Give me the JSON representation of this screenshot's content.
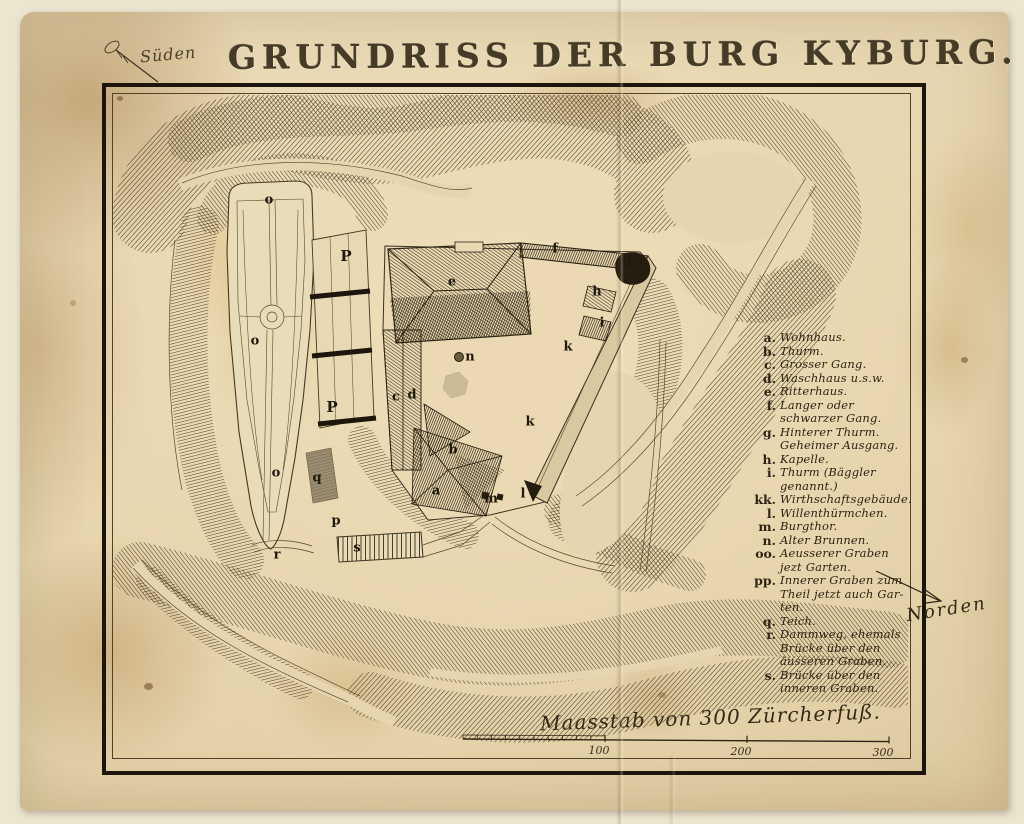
{
  "page": {
    "title": "GRUNDRISS DER BURG KYBURG.",
    "orientation_top": "Süden",
    "orientation_right": "Norden"
  },
  "legend": {
    "entries": [
      {
        "key": "a.",
        "lines": [
          "Wohnhaus."
        ]
      },
      {
        "key": "b.",
        "lines": [
          "Thurm."
        ]
      },
      {
        "key": "c.",
        "lines": [
          "Grosser Gang."
        ]
      },
      {
        "key": "d.",
        "lines": [
          "Waschhaus u.s.w."
        ]
      },
      {
        "key": "e.",
        "lines": [
          "Ritterhaus."
        ]
      },
      {
        "key": "f.",
        "lines": [
          "Langer oder",
          "schwarzer Gang."
        ]
      },
      {
        "key": "g.",
        "lines": [
          "Hinterer Thurm.",
          "Geheimer Ausgang."
        ]
      },
      {
        "key": "h.",
        "lines": [
          "Kapelle."
        ]
      },
      {
        "key": "i.",
        "lines": [
          "Thurm (Bäggler",
          "genannt.)"
        ]
      },
      {
        "key": "kk.",
        "lines": [
          "Wirthschaftsgebäude."
        ]
      },
      {
        "key": "l.",
        "lines": [
          "Willenthürmchen."
        ]
      },
      {
        "key": "m.",
        "lines": [
          "Burgthor."
        ]
      },
      {
        "key": "n.",
        "lines": [
          "Alter Brunnen."
        ]
      },
      {
        "key": "oo.",
        "lines": [
          "Aeusserer Graben",
          "jezt Garten."
        ]
      },
      {
        "key": "pp.",
        "lines": [
          "Innerer Graben zum",
          "Theil jetzt auch Gar-",
          "ten."
        ]
      },
      {
        "key": "q.",
        "lines": [
          "Teich."
        ]
      },
      {
        "key": "r.",
        "lines": [
          "Dammweg, ehemals",
          "Brücke über den",
          "äusseren Graben."
        ]
      },
      {
        "key": "s.",
        "lines": [
          "Brücke über den",
          "inneren Graben."
        ]
      }
    ]
  },
  "scale": {
    "caption": "Maasstab von 300 Zürcherfuß.",
    "ticks": [
      "100",
      "200",
      "300"
    ]
  },
  "map_annotations": [
    {
      "label": "o",
      "x": 269,
      "y": 200
    },
    {
      "label": "P",
      "x": 346,
      "y": 256
    },
    {
      "label": "o",
      "x": 255,
      "y": 341
    },
    {
      "label": "P",
      "x": 332,
      "y": 407
    },
    {
      "label": "o",
      "x": 276,
      "y": 473
    },
    {
      "label": "q",
      "x": 317,
      "y": 478
    },
    {
      "label": "p",
      "x": 336,
      "y": 521
    },
    {
      "label": "r",
      "x": 277,
      "y": 555
    },
    {
      "label": "s",
      "x": 357,
      "y": 548
    },
    {
      "label": "c",
      "x": 396,
      "y": 397
    },
    {
      "label": "d",
      "x": 412,
      "y": 395
    },
    {
      "label": "e",
      "x": 452,
      "y": 282
    },
    {
      "label": "n",
      "x": 470,
      "y": 357
    },
    {
      "label": "f",
      "x": 555,
      "y": 249
    },
    {
      "label": "g",
      "x": 627,
      "y": 261
    },
    {
      "label": "h",
      "x": 597,
      "y": 292
    },
    {
      "label": "i",
      "x": 602,
      "y": 323
    },
    {
      "label": "k",
      "x": 568,
      "y": 347
    },
    {
      "label": "k",
      "x": 530,
      "y": 422
    },
    {
      "label": "b",
      "x": 453,
      "y": 450
    },
    {
      "label": "a",
      "x": 436,
      "y": 491
    },
    {
      "label": "l",
      "x": 523,
      "y": 494
    },
    {
      "label": "m",
      "x": 491,
      "y": 499
    }
  ],
  "colors": {
    "paper": "#e6d6b0",
    "ink": "#2c2414",
    "hachure": "#453a21",
    "stain": "#b98a44"
  }
}
